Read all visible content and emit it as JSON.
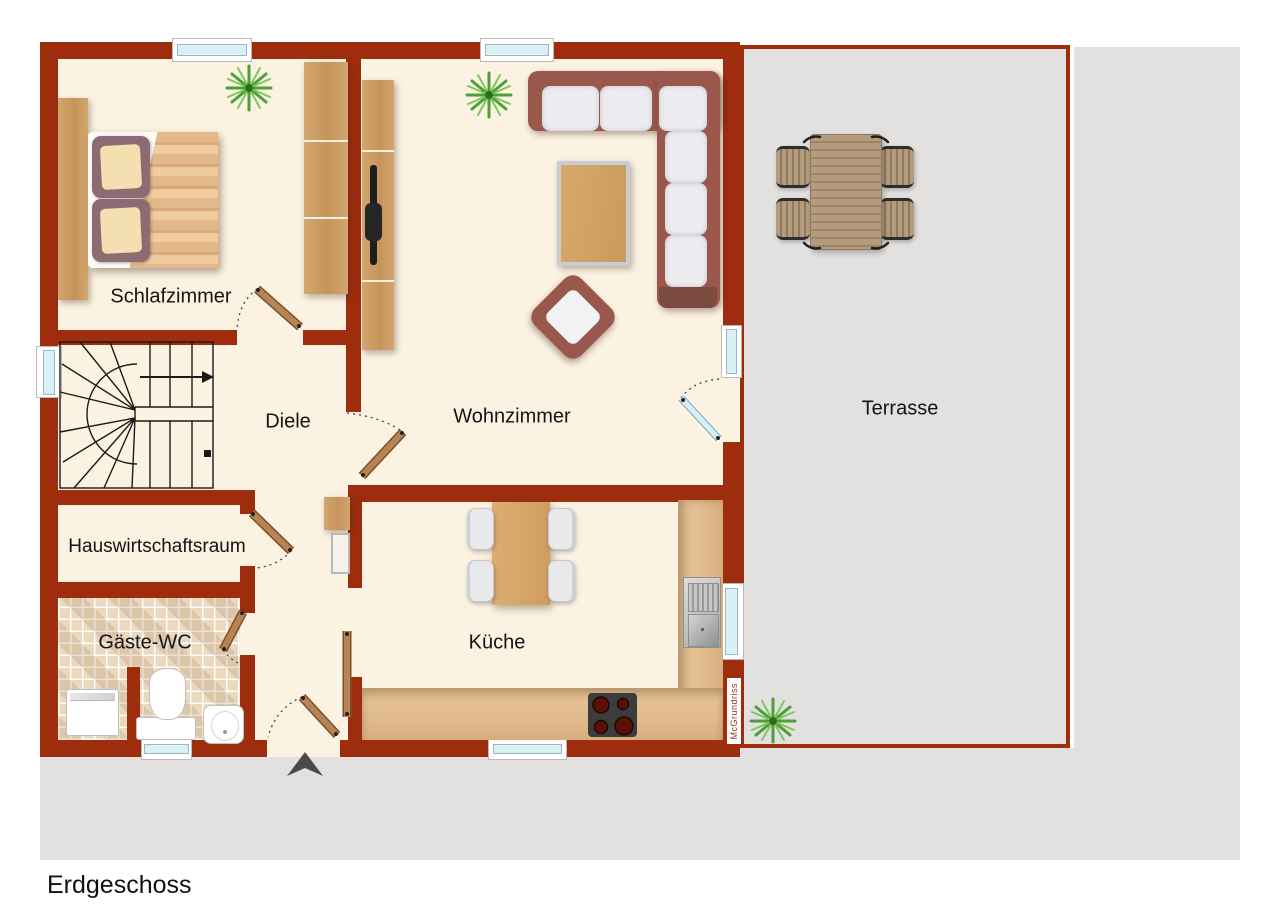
{
  "plan": {
    "floor_label": "Erdgeschoss",
    "watermark": "McGrundriss",
    "rooms": {
      "schlafzimmer": {
        "label": "Schlafzimmer"
      },
      "diele": {
        "label": "Diele"
      },
      "wohnzimmer": {
        "label": "Wohnzimmer"
      },
      "hauswirtschaftsraum": {
        "label": "Hauswirtschaftsraum"
      },
      "gaeste_wc": {
        "label": "Gäste-WC"
      },
      "kueche": {
        "label": "Küche"
      },
      "terrasse": {
        "label": "Terrasse"
      }
    },
    "furniture_icons": [
      "double-bed",
      "wardrobe",
      "sideboard-with-tv",
      "potted-plant",
      "corner-sofa",
      "coffee-table",
      "armchair",
      "winder-staircase",
      "washing-machine",
      "toilet",
      "hand-basin",
      "kitchen-counter",
      "kitchen-sink",
      "stove-hob",
      "kitchen-table-with-chairs",
      "terrace-dining-set",
      "entrance-arrow"
    ],
    "colors": {
      "wall": "#9E2D0E",
      "floor": "#FBF2E1",
      "outdoor": "#E2E1DF",
      "tile": "#EAD9BF",
      "wood": "#C79A62",
      "counter": "#E0BA8D",
      "door_wood": "#B78455",
      "window_glass": "#D8F0F6",
      "sofa_frame": "#9A584C",
      "cushion": "#ECEBEF",
      "terrace_wood": "#B49B7D",
      "label_text": "#141414",
      "watermark_text": "#9E2D0E"
    }
  }
}
